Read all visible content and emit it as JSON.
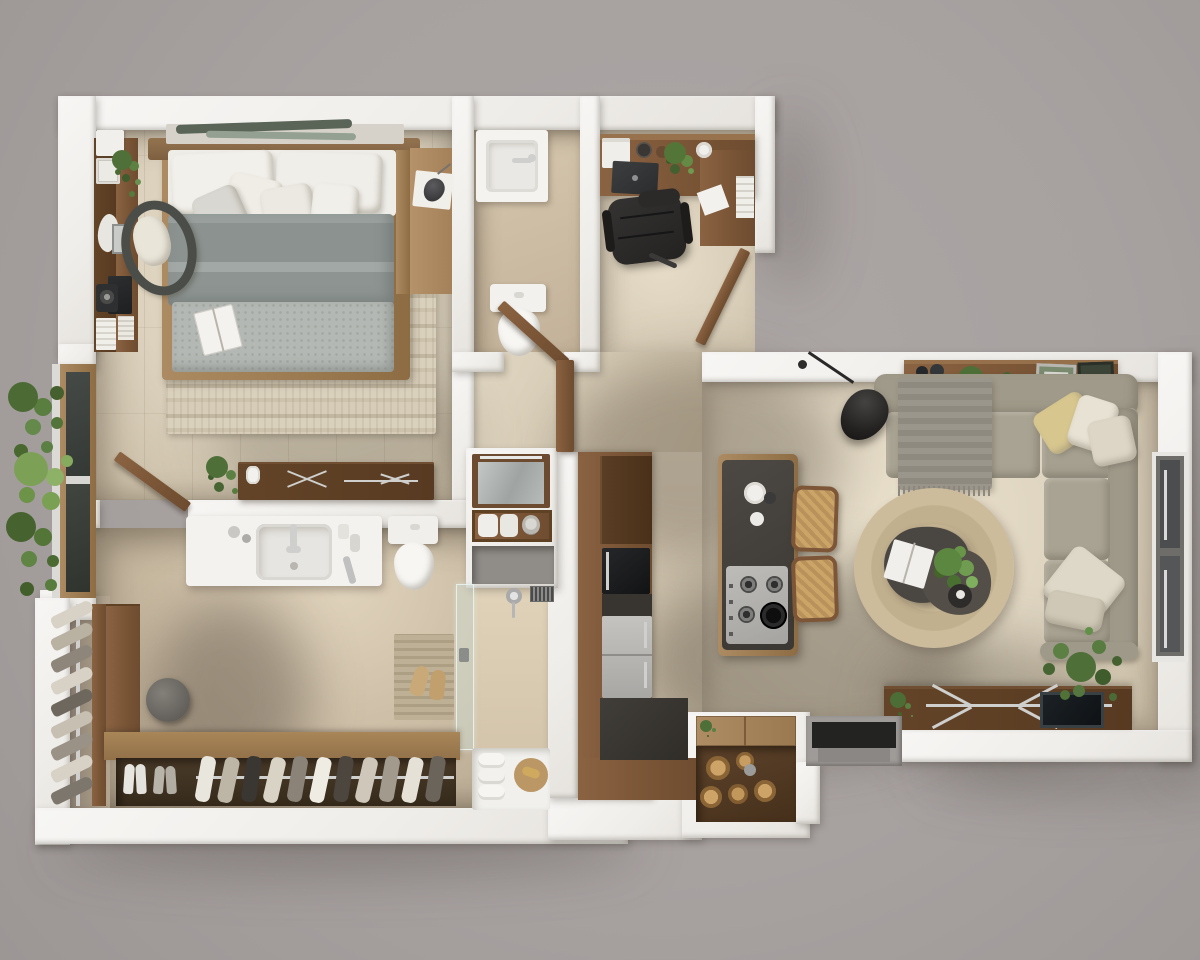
{
  "meta": {
    "title": "Top-down 3D rendered floor plan of a one-bedroom apartment",
    "view": "orthographic top-down render",
    "canvas": {
      "width": 1200,
      "height": 960
    },
    "visible_text": "none"
  },
  "palette": {
    "background": "#a7a1a0",
    "wall": "#f2f0ed",
    "floor_warm_tile": "#ddd3c0",
    "floor_bathroom": "#cdbda6",
    "wood_mid": "#85603f",
    "wood_light": "#a8854f",
    "walnut_dark": "#5c4027",
    "charcoal": "#3a3733",
    "stainless": "#b7b6b3",
    "sofa_taupe": "#a6a090",
    "jute_rug": "#c7b795",
    "duvet_gray": "#8e9694",
    "throw_gray": "#b4b8b4",
    "rattan": "#c49e66",
    "pillow_yellow": "#d7c68e",
    "glass": "#d2e0d6",
    "foliage_green": "#567a3c"
  },
  "scene": {
    "type": "apartment-floor-plan-3d-render",
    "rooms": [
      {
        "id": "bedroom",
        "label": "Bedroom",
        "furniture": [
          "double bed with wood frame",
          "six white and gray pillows",
          "gray duvet",
          "textured throw with open book",
          "striped cream area rug",
          "headboard shelf with two decor boards",
          "side bench and shelf with reading lamp and book",
          "wall media console",
          "leaning TV panel",
          "round speaker",
          "white storage boxes",
          "stacked white books",
          "coral ornament",
          "potted plant on console",
          "rattan armchair with cream cushion",
          "walnut dresser with metal inlay handles",
          "candle jar",
          "floor plant beside dresser",
          "open door to bathroom"
        ]
      },
      {
        "id": "bathroom-top",
        "label": "Toilet room",
        "furniture": [
          "white wash basin with faucet",
          "toilet",
          "open wooden door",
          "beige tile floor"
        ]
      },
      {
        "id": "home-office",
        "label": "Home office nook",
        "furniture": [
          "L-shaped walnut desk",
          "black leather office chair",
          "laptop",
          "white printer",
          "two bowls",
          "potted plant",
          "coffee cup",
          "loose paper sheet",
          "white books in wall niche",
          "open wooden door to living area"
        ]
      },
      {
        "id": "hallway",
        "label": "Hallway",
        "furniture": [
          "recessed mirror cabinet with light bar",
          "wooden toiletry shelf with rolled towels",
          "gray wall niche",
          "standing wooden door panel"
        ]
      },
      {
        "id": "kitchen",
        "label": "Kitchen run",
        "furniture": [
          "L-shaped walnut cabinet band",
          "tall dark pantry front",
          "built-in black oven",
          "charcoal countertop",
          "stainless steel fridge",
          "island with charcoal top",
          "gas cooktop with 4 burners and cast-iron grate",
          "coffee cups on island",
          "two rattan counter stools"
        ],
        "counts": {
          "cooktop_burners": 4,
          "stools": 2
        }
      },
      {
        "id": "living-room",
        "label": "Living room",
        "furniture": [
          "walnut console with bottles, plant and framed pictures",
          "L-shaped sectional sofa in taupe",
          "yellow pillow",
          "two cream pillows",
          "two beige pillows",
          "fringed gray throw",
          "black arc floor lamp",
          "round jute rug",
          "organic-shaped dark coffee table with plant, book and bowl",
          "walnut TV sideboard with flat TV and metal cross legs",
          "small plant on sideboard",
          "large corner plant",
          "picture window on right wall"
        ]
      },
      {
        "id": "bathroom-main",
        "label": "Bathroom with shower",
        "furniture": [
          "white vanity with rectangular basin",
          "chrome faucet",
          "toiletries and razor",
          "toilet",
          "glass shower partition with handle",
          "shower head with hose",
          "wall vent grille",
          "ribbed teak shower mat",
          "pair of slippers",
          "white shower tray",
          "three rolled towels",
          "round wooden tray with soap"
        ]
      },
      {
        "id": "walk-in-closet",
        "label": "Walk-in closet",
        "furniture": [
          "vertical shoe rack with rail",
          "wooden side cabinet",
          "round gray pouf",
          "shoe bench with open cubby",
          "hanging rail with boots and shoes",
          "two shoe pairs on floor"
        ],
        "counts": {
          "rack_shoes": 9,
          "hanging_shoes": 11,
          "floor_shoe_pairs": 2
        }
      },
      {
        "id": "balcony-planter",
        "label": "Balcony planter",
        "furniture": [
          "dense ferns and palm foliage",
          "wood framed window with two dark panes"
        ]
      },
      {
        "id": "entry",
        "label": "Entry",
        "furniture": [
          "recessed doorway with dark threshold",
          "concrete step",
          "built-in jar niche with wooden lid"
        ],
        "counts": {
          "jars": 5
        }
      }
    ]
  }
}
